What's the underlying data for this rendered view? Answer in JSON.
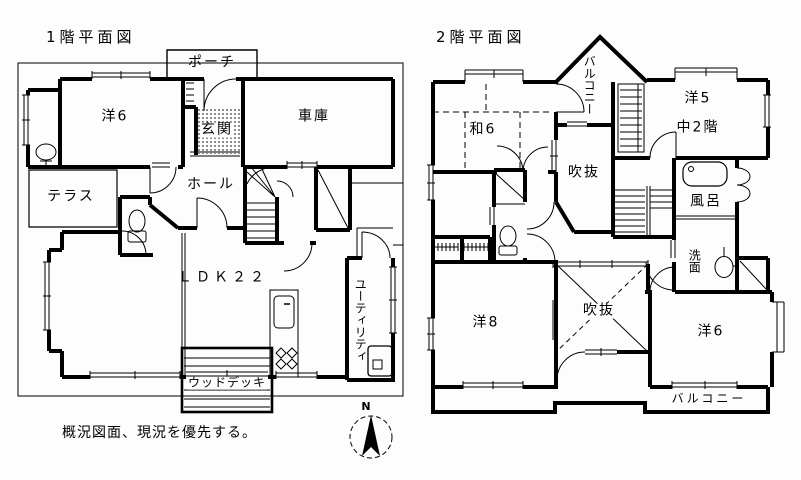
{
  "meta": {
    "bg": "#fdfdfd",
    "ink": "#000000"
  },
  "floor1": {
    "title": "1階平面図",
    "rooms": {
      "porch": "ポーチ",
      "western6": "洋6",
      "entrance": "玄関",
      "garage": "車庫",
      "terrace": "テラス",
      "hall": "ホール",
      "ldk": "ＬＤＫ２２",
      "wood_deck": "ウッドデッキ",
      "utility": "ユーティリティ"
    }
  },
  "floor2": {
    "title": "2階平面図",
    "rooms": {
      "balcony_top": "バルコニー",
      "japanese6": "和6",
      "western5": "洋5",
      "mezzanine": "中2階",
      "void_upper": "吹抜",
      "bath": "風呂",
      "washroom": "洗面",
      "western8": "洋8",
      "void_lower": "吹抜",
      "western6": "洋6",
      "balcony_bottom": "バルコニー"
    }
  },
  "annotations": {
    "note": "概況図面、現況を優先する。",
    "compass_north": "N"
  }
}
